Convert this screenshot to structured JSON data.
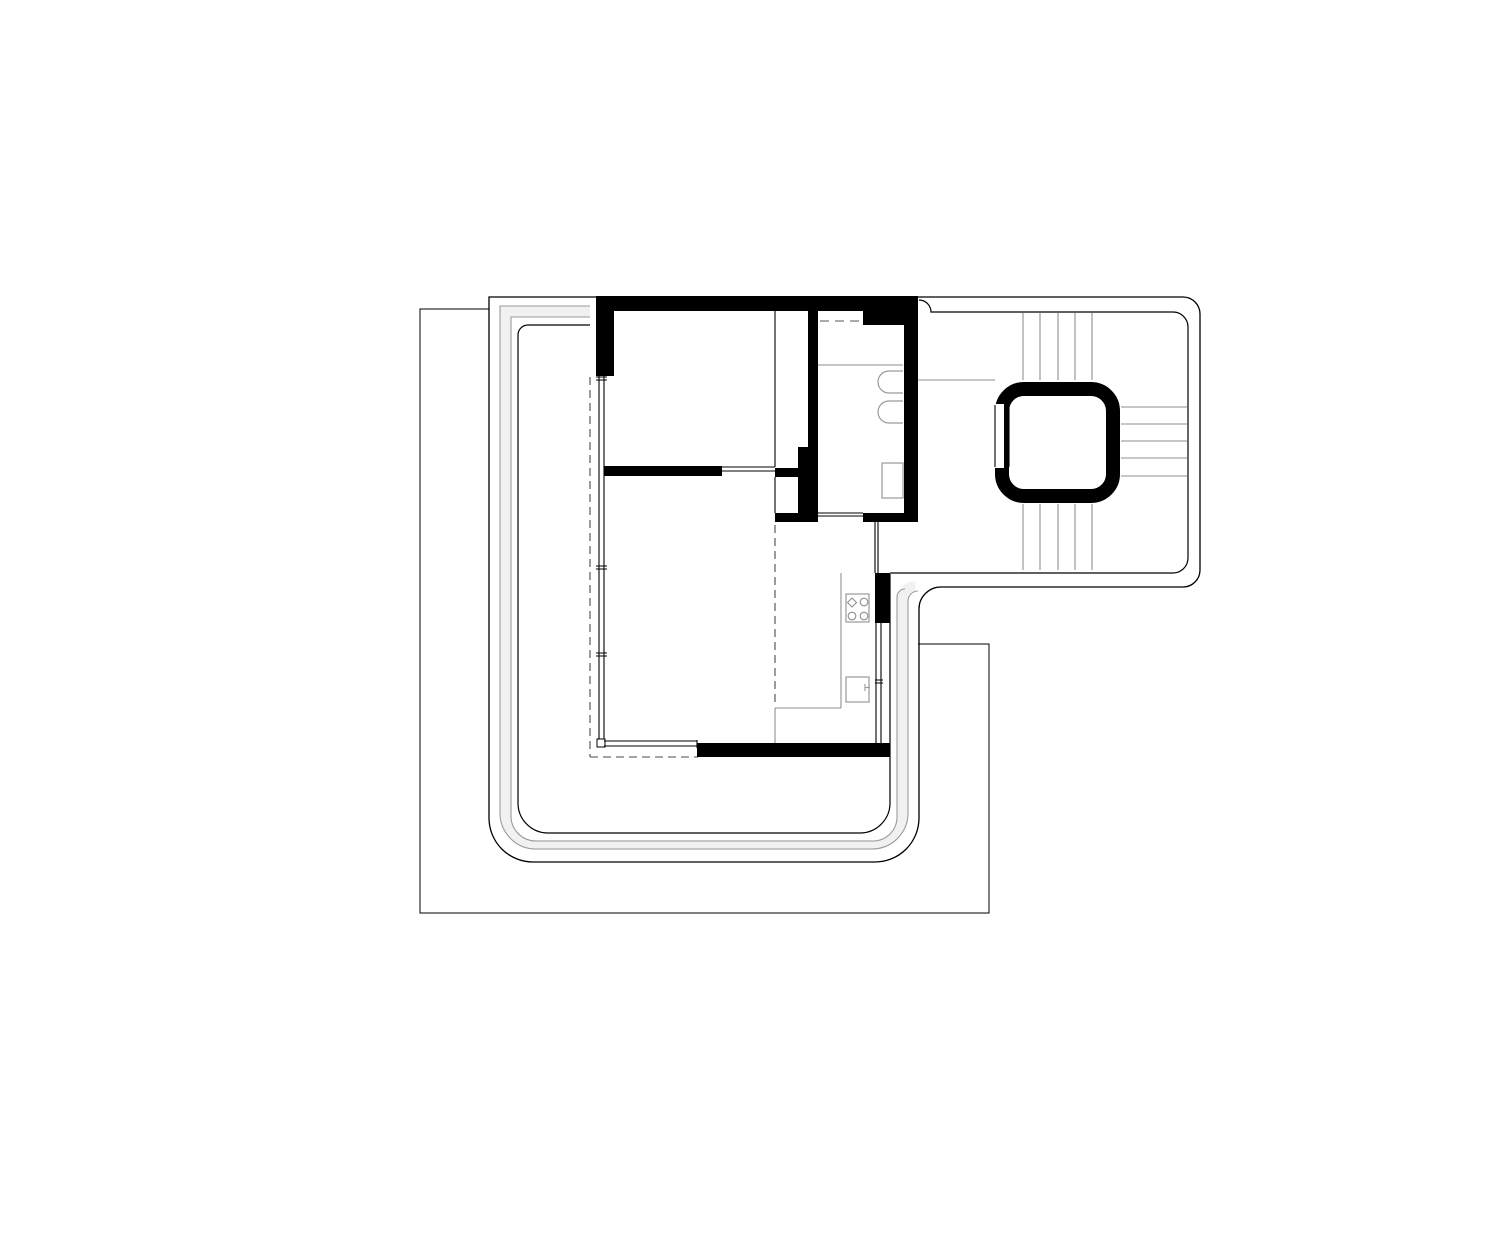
{
  "drawing": {
    "kind": "architectural-floor-plan",
    "canvas": {
      "width": 1500,
      "height": 1243,
      "background": "#ffffff"
    },
    "colors": {
      "wall": "#000000",
      "boundary": "#000000",
      "interior_gray": "#8f8f8f",
      "band_edge": "#9a9a9a",
      "band_fill": "#f1f1f1",
      "fixture": "#9a9a9a",
      "dashed": "#4a4a4a"
    },
    "elements": [
      {
        "type": "path",
        "name": "terrace-band-fill",
        "d": "M590 311.5 L505.5 311.5 L505.5 815 A30 30 0 0 0 535.5 845 L872.5 845 A30 30 0 0 0 902.5 815 L902.5 599 A13 13 0 0 1 915.5 586",
        "stroke": "#f1f1f1",
        "width": 10,
        "fill": "none"
      },
      {
        "type": "path",
        "name": "terrace-band-outer-edge",
        "d": "M590 306 L500 306 L500 813 A36 36 0 0 0 536 849 L872 849 A36 36 0 0 0 908 813 L908 601 A10 10 0 0 1 918 591",
        "stroke": "#9a9a9a",
        "width": 1.1,
        "fill": "none"
      },
      {
        "type": "path",
        "name": "terrace-band-inner-edge",
        "d": "M590 317 L511 317 L511 816 A25 25 0 0 0 536 841 L873 841 A24 24 0 0 0 897 817 L897 597 A8 8 0 0 1 905 589",
        "stroke": "#9a9a9a",
        "width": 1.1,
        "fill": "none"
      },
      {
        "type": "polyline",
        "name": "site-boundary",
        "points": "489,309 420,309 420,913 989,913 989,644 918,644",
        "stroke": "#000000",
        "width": 1,
        "fill": "none"
      },
      {
        "type": "path",
        "name": "apartment-outer-boundary",
        "d": "M489 297 L1183 297 A17 17 0 0 1 1200 314 L1200 570 A17 17 0 0 1 1183 587 L941 587 A22 22 0 0 0 919 609 L919 818 A44 44 0 0 1 875 862 L533 862 A44 44 0 0 1 489 818 Z",
        "stroke": "#000000",
        "width": 1.3,
        "fill": "none"
      },
      {
        "type": "path",
        "name": "apartment-inner-boundary-right",
        "d": "M919 300 A12 12 0 0 1 931 312 L1173 312 A15 15 0 0 1 1188 327 L1188 558 A15 15 0 0 1 1173 573 L890 573",
        "stroke": "#000000",
        "width": 1.2,
        "fill": "none"
      },
      {
        "type": "path",
        "name": "apartment-inner-boundary-left",
        "d": "M590 325 L528 325 A10 10 0 0 0 518 335 L518 803 A30 30 0 0 0 548 833 L860 833 A30 30 0 0 0 890 803 L890 574",
        "stroke": "#000000",
        "width": 1.2,
        "fill": "none"
      },
      {
        "type": "line",
        "name": "shower-partition-line",
        "x1": 818,
        "y1": 365,
        "x2": 903,
        "y2": 365,
        "stroke": "#8f8f8f",
        "width": 1.1
      },
      {
        "type": "line",
        "name": "stair-landing-line",
        "x1": 918,
        "y1": 380,
        "x2": 995,
        "y2": 380,
        "stroke": "#8f8f8f",
        "width": 1.1
      },
      {
        "type": "line",
        "name": "kitchen-counter-left-edge",
        "x1": 841,
        "y1": 573,
        "x2": 841,
        "y2": 708,
        "stroke": "#8f8f8f",
        "width": 1.1
      },
      {
        "type": "line",
        "name": "kitchen-counter-front-edge",
        "x1": 775,
        "y1": 708,
        "x2": 841,
        "y2": 708,
        "stroke": "#8f8f8f",
        "width": 1.1
      },
      {
        "type": "line",
        "name": "kitchen-counter-return-edge",
        "x1": 775,
        "y1": 708,
        "x2": 775,
        "y2": 743,
        "stroke": "#8f8f8f",
        "width": 1.1
      },
      {
        "type": "lines",
        "name": "stair-treads-upper-flight",
        "stroke": "#8f8f8f",
        "width": 1.1,
        "segments": [
          [
            1023,
            313,
            1023,
            380
          ],
          [
            1040,
            313,
            1040,
            380
          ],
          [
            1058,
            313,
            1058,
            380
          ],
          [
            1075,
            313,
            1075,
            380
          ],
          [
            1092,
            313,
            1092,
            380
          ]
        ]
      },
      {
        "type": "lines",
        "name": "stair-treads-lower-flight",
        "stroke": "#8f8f8f",
        "width": 1.1,
        "segments": [
          [
            1023,
            504,
            1023,
            570
          ],
          [
            1040,
            504,
            1040,
            570
          ],
          [
            1058,
            504,
            1058,
            570
          ],
          [
            1075,
            504,
            1075,
            570
          ],
          [
            1092,
            504,
            1092,
            570
          ]
        ]
      },
      {
        "type": "lines",
        "name": "stair-treads-east-flight",
        "stroke": "#8f8f8f",
        "width": 1.1,
        "segments": [
          [
            1121,
            407,
            1187,
            407
          ],
          [
            1121,
            424,
            1187,
            424
          ],
          [
            1121,
            441,
            1187,
            441
          ],
          [
            1121,
            458,
            1187,
            458
          ],
          [
            1121,
            476,
            1187,
            476
          ]
        ]
      },
      {
        "type": "line",
        "name": "dashed-outline-west",
        "x1": 590,
        "y1": 377,
        "x2": 590,
        "y2": 757,
        "stroke": "#4a4a4a",
        "width": 1.1,
        "dash": "8,5"
      },
      {
        "type": "line",
        "name": "dashed-outline-south",
        "x1": 590,
        "y1": 757,
        "x2": 698,
        "y2": 757,
        "stroke": "#4a4a4a",
        "width": 1.1,
        "dash": "8,5"
      },
      {
        "type": "line",
        "name": "dashed-outline-center",
        "x1": 775,
        "y1": 525,
        "x2": 775,
        "y2": 707,
        "stroke": "#4a4a4a",
        "width": 1.1,
        "dash": "8,5"
      },
      {
        "type": "line",
        "name": "dashed-bath-door-head",
        "x1": 820,
        "y1": 321,
        "x2": 863,
        "y2": 321,
        "stroke": "#777777",
        "width": 1.2,
        "dash": "9,6"
      },
      {
        "type": "rect",
        "name": "wall-north",
        "x": 596,
        "y": 296,
        "w": 322,
        "h": 15,
        "fill": "#000000"
      },
      {
        "type": "rect",
        "name": "wall-west-upper",
        "x": 596,
        "y": 296,
        "w": 18,
        "h": 80,
        "fill": "#000000"
      },
      {
        "type": "rect",
        "name": "wall-bath-west",
        "x": 808,
        "y": 311,
        "w": 10,
        "h": 136,
        "fill": "#000000"
      },
      {
        "type": "rect",
        "name": "wall-bath-west-lower",
        "x": 798,
        "y": 447,
        "w": 20,
        "h": 75,
        "fill": "#000000"
      },
      {
        "type": "rect",
        "name": "wall-duct-top-bar",
        "x": 775,
        "y": 468,
        "w": 23,
        "h": 9,
        "fill": "#000000"
      },
      {
        "type": "rect",
        "name": "wall-duct-bottom-bar",
        "x": 775,
        "y": 513,
        "w": 43,
        "h": 9,
        "fill": "#000000"
      },
      {
        "type": "rect",
        "name": "wall-bath-north-thick",
        "x": 863,
        "y": 311,
        "w": 41,
        "h": 14,
        "fill": "#000000"
      },
      {
        "type": "rect",
        "name": "wall-bath-east",
        "x": 904,
        "y": 296,
        "w": 14,
        "h": 226,
        "fill": "#000000"
      },
      {
        "type": "rect",
        "name": "wall-bath-south",
        "x": 863,
        "y": 513,
        "w": 55,
        "h": 9,
        "fill": "#000000"
      },
      {
        "type": "rect",
        "name": "wall-living-north",
        "x": 604,
        "y": 466,
        "w": 118,
        "h": 10,
        "fill": "#000000"
      },
      {
        "type": "rect",
        "name": "wall-south",
        "x": 697,
        "y": 743,
        "w": 193,
        "h": 14,
        "fill": "#000000"
      },
      {
        "type": "rect",
        "name": "wall-kitchen-east",
        "x": 875,
        "y": 573,
        "w": 15,
        "h": 50,
        "fill": "#000000"
      },
      {
        "type": "lines",
        "name": "window-west-glazing",
        "stroke": "#000000",
        "width": 1.1,
        "segments": [
          [
            599,
            376,
            599,
            742
          ],
          [
            604,
            376,
            604,
            742
          ]
        ]
      },
      {
        "type": "lines",
        "name": "window-west-mullion-ticks",
        "stroke": "#000000",
        "width": 1,
        "segments": [
          [
            596,
            377,
            607,
            377
          ],
          [
            596,
            380,
            607,
            380
          ],
          [
            596,
            566,
            607,
            566
          ],
          [
            596,
            569,
            607,
            569
          ],
          [
            596,
            653,
            607,
            653
          ],
          [
            596,
            656,
            607,
            656
          ]
        ]
      },
      {
        "type": "rect",
        "name": "window-sill-box",
        "x": 597,
        "y": 739,
        "w": 8,
        "h": 8,
        "fill": "#ffffff",
        "stroke": "#000000",
        "width": 1
      },
      {
        "type": "lines",
        "name": "window-interior-partition",
        "stroke": "#000000",
        "width": 1.1,
        "segments": [
          [
            722,
            467,
            775,
            467
          ],
          [
            722,
            471,
            775,
            471
          ]
        ]
      },
      {
        "type": "lines",
        "name": "window-bath-south",
        "stroke": "#000000",
        "width": 1.1,
        "segments": [
          [
            818,
            513,
            863,
            513
          ],
          [
            818,
            516,
            863,
            516
          ]
        ]
      },
      {
        "type": "lines",
        "name": "window-kitchen-east",
        "stroke": "#000000",
        "width": 1.1,
        "segments": [
          [
            876,
            623,
            876,
            743
          ],
          [
            881,
            623,
            881,
            743
          ]
        ]
      },
      {
        "type": "lines",
        "name": "window-kitchen-east-ticks",
        "stroke": "#000000",
        "width": 1,
        "segments": [
          [
            875,
            680,
            883,
            680
          ],
          [
            875,
            683,
            883,
            683
          ]
        ]
      },
      {
        "type": "lines",
        "name": "window-connector-east",
        "stroke": "#000000",
        "width": 1.1,
        "segments": [
          [
            875,
            522,
            875,
            573
          ],
          [
            878,
            522,
            878,
            573
          ]
        ]
      },
      {
        "type": "lines",
        "name": "window-living-south",
        "stroke": "#000000",
        "width": 1.1,
        "segments": [
          [
            604,
            741,
            697,
            741
          ],
          [
            604,
            746,
            697,
            746
          ],
          [
            697,
            740,
            697,
            748
          ]
        ]
      },
      {
        "type": "line",
        "name": "partition-face-line",
        "x1": 775,
        "y1": 311,
        "x2": 775,
        "y2": 467,
        "stroke": "#000000",
        "width": 1.1
      },
      {
        "type": "line",
        "name": "duct-west-face-line",
        "x1": 775,
        "y1": 477,
        "x2": 775,
        "y2": 513,
        "stroke": "#000000",
        "width": 1.1
      },
      {
        "type": "rect",
        "name": "elevator-shaft",
        "x": 1002,
        "y": 389,
        "w": 111,
        "h": 107,
        "rx": 22,
        "fill": "#ffffff",
        "stroke": "#000000",
        "width": 14
      },
      {
        "type": "rect",
        "name": "elevator-door-gap",
        "x": 987,
        "y": 404,
        "w": 17,
        "h": 64,
        "fill": "#ffffff"
      },
      {
        "type": "lines",
        "name": "elevator-door-jambs",
        "stroke": "#000000",
        "width": 1.1,
        "segments": [
          [
            995,
            405,
            995,
            467
          ],
          [
            1009,
            405,
            1009,
            467
          ]
        ]
      },
      {
        "type": "path",
        "name": "toilet-fixture-1",
        "d": "M903 371 L889 371 A11 11 0 0 0 878 382 A11 11 0 0 0 889 393 L903 393",
        "stroke": "#9a9a9a",
        "width": 1.2,
        "fill": "#ffffff"
      },
      {
        "type": "path",
        "name": "toilet-fixture-2",
        "d": "M903 401 L889 401 A11 11 0 0 0 878 412 A11 11 0 0 0 889 423 L903 423",
        "stroke": "#9a9a9a",
        "width": 1.2,
        "fill": "#ffffff"
      },
      {
        "type": "rect",
        "name": "bath-sink-fixture",
        "x": 882,
        "y": 463,
        "w": 21,
        "h": 35,
        "fill": "#ffffff",
        "stroke": "#9a9a9a",
        "width": 1.2
      },
      {
        "type": "rect",
        "name": "cooktop-fixture",
        "x": 846,
        "y": 594,
        "w": 23,
        "h": 28,
        "fill": "#ffffff",
        "stroke": "#9a9a9a",
        "width": 1.2
      },
      {
        "type": "path",
        "name": "cooktop-burner-diamond",
        "d": "M852 598 L856.5 602.5 L852 607 L847.5 602.5 Z",
        "stroke": "#8f8f8f",
        "width": 1.1,
        "fill": "none"
      },
      {
        "type": "circle",
        "name": "cooktop-burner-1",
        "cx": 864,
        "cy": 602,
        "r": 3.8,
        "stroke": "#8f8f8f",
        "width": 1.1,
        "fill": "none"
      },
      {
        "type": "circle",
        "name": "cooktop-burner-2",
        "cx": 852,
        "cy": 616,
        "r": 3.8,
        "stroke": "#8f8f8f",
        "width": 1.1,
        "fill": "none"
      },
      {
        "type": "circle",
        "name": "cooktop-burner-3",
        "cx": 864,
        "cy": 616,
        "r": 3.8,
        "stroke": "#8f8f8f",
        "width": 1.1,
        "fill": "none"
      },
      {
        "type": "rect",
        "name": "kitchen-sink-fixture",
        "x": 846,
        "y": 677,
        "w": 23,
        "h": 25,
        "fill": "#ffffff",
        "stroke": "#9a9a9a",
        "width": 1.2
      },
      {
        "type": "lines",
        "name": "kitchen-sink-tap",
        "stroke": "#9a9a9a",
        "width": 1.1,
        "segments": [
          [
            865,
            684,
            865,
            691
          ],
          [
            865,
            687.5,
            870,
            687.5
          ]
        ]
      }
    ]
  }
}
